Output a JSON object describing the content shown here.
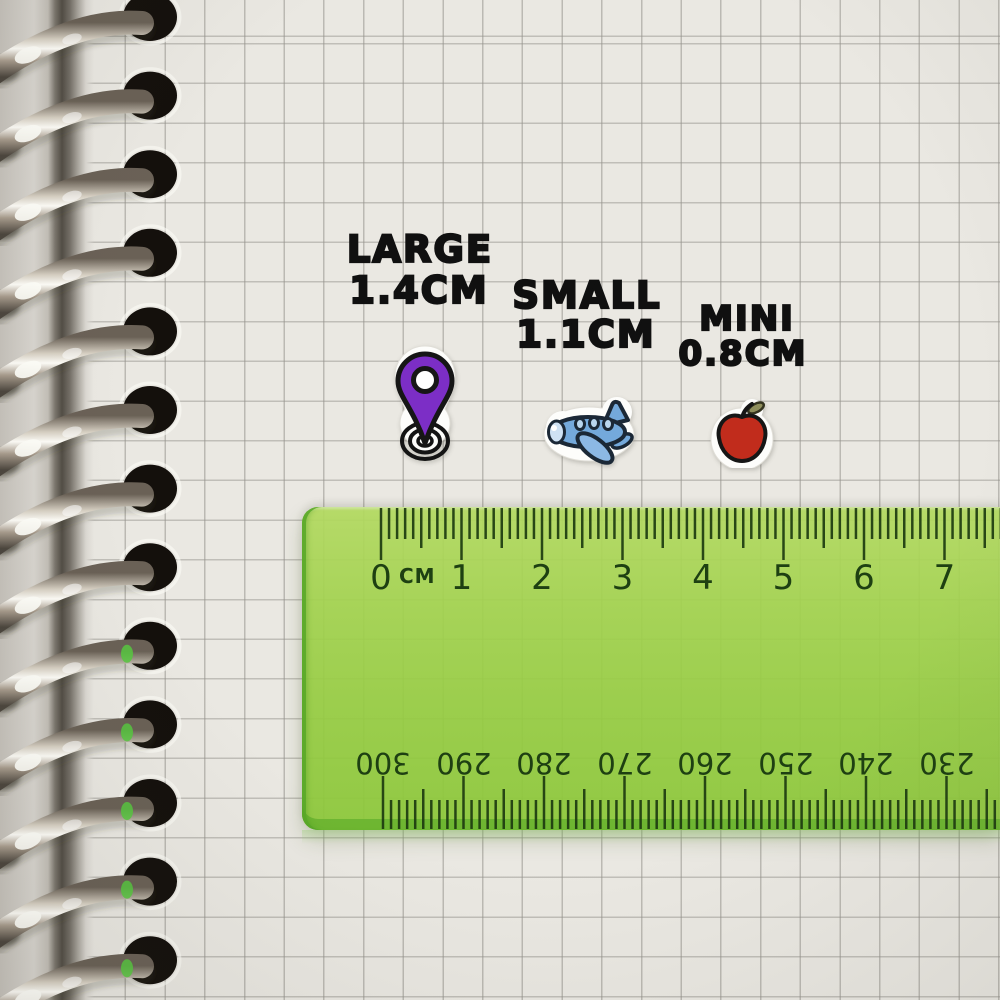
{
  "labels": {
    "large": {
      "title": "LARGE",
      "size": "1.4CM"
    },
    "small": {
      "title": "SMALL",
      "size": "1.1CM"
    },
    "mini": {
      "title": "MINI",
      "size": "0.8CM"
    }
  },
  "stickers": {
    "pin": {
      "icon": "location-pin-icon",
      "fill": "#7c2ec6"
    },
    "plane": {
      "icon": "airplane-icon",
      "fill": "#74a9db"
    },
    "apple": {
      "icon": "apple-icon",
      "fill": "#c12c1c"
    }
  },
  "ruler": {
    "unit_label": "CM",
    "top_numbers": [
      "0",
      "1",
      "2",
      "3",
      "4",
      "5",
      "6",
      "7"
    ],
    "bottom_numbers": [
      "300",
      "290",
      "280",
      "270",
      "260",
      "250",
      "240",
      "230"
    ],
    "body_color": "#9ed24f",
    "mark_color": "#1e4012"
  },
  "notebook": {
    "paper_color": "#eae8e2",
    "grid_color": "#9b9994",
    "ring_count": 13
  }
}
